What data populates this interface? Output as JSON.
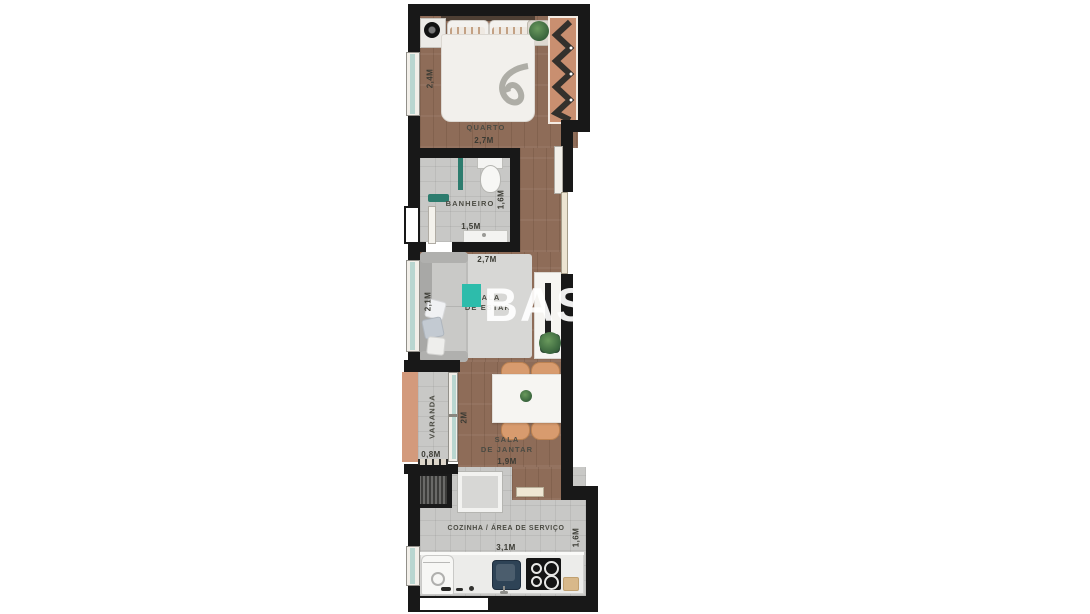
{
  "watermark": {
    "text": "BASMA"
  },
  "colors": {
    "wall": "#181818",
    "wood": "#8e6c58",
    "tile": "#c8c8c6",
    "rug": "#d7d7d5",
    "teal": "#2dbcab",
    "teal-dark": "#2d7c6e",
    "glass": "#b9d6d0",
    "salmon": "#d39a7c",
    "wardrobe": "#c98f70",
    "chair": "#d89b6e",
    "sink": "#2e4356",
    "counter": "#ececea",
    "sofa": "#bcbcba",
    "table": "#f6f5f2"
  },
  "rooms": {
    "quarto": {
      "name": "QUARTO",
      "dim_w": "2,7M",
      "dim_h": "2,4M"
    },
    "banheiro": {
      "name": "BANHEIRO",
      "dim_w": "1,5M",
      "dim_h": "1,6M"
    },
    "sala_estar": {
      "name_line1": "SALA",
      "name_line2": "DE ESTAR",
      "dim_w": "2,7M",
      "dim_h": "2,1M"
    },
    "varanda": {
      "name": "VARANDA",
      "dim_w": "0,8M"
    },
    "sala_jantar": {
      "name_line1": "SALA",
      "name_line2": "DE JANTAR",
      "dim_w": "1,9M",
      "dim_h": "2M"
    },
    "cozinha": {
      "name": "COZINHA / ÁREA DE SERVIÇO",
      "dim_w": "3,1M",
      "dim_h": "1,6M"
    }
  }
}
